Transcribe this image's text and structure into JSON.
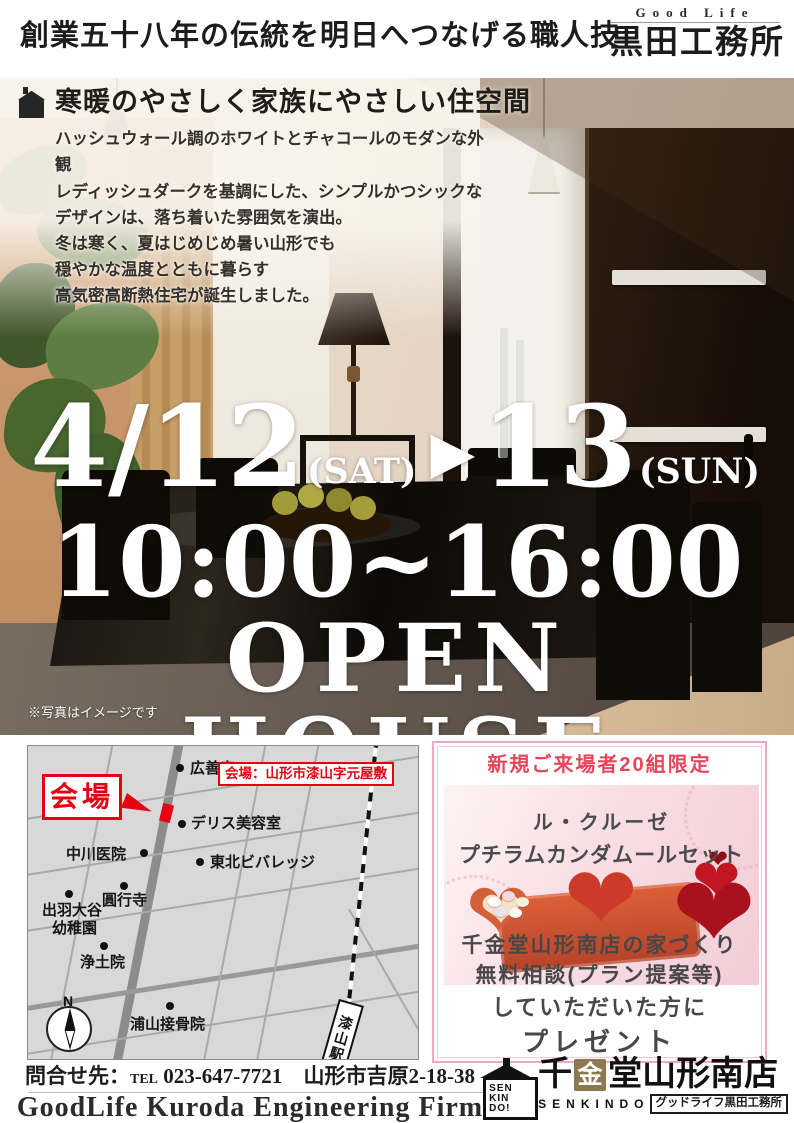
{
  "header": {
    "tagline": "創業五十八年の伝統を明日へつなげる職人技",
    "brand_en": "Good Life",
    "brand_ja": "黒田工務所"
  },
  "hero": {
    "headline": "寒暖のやさしく家族にやさしい住空間",
    "description_lines": [
      "ハッシュウォール調のホワイトとチャコールのモダンな外観",
      "レディッシュダークを基調にした、シンプルかつシックな",
      "デザインは、落ち着いた雰囲気を演出。",
      "冬は寒く、夏はじめじめ暑い山形でも",
      "穏やかな温度とともに暮らす",
      "高気密高断熱住宅が誕生しました。"
    ],
    "date_start": "4/12",
    "date_start_day": "(SAT)",
    "arrow": "▶",
    "date_end": "13",
    "date_end_day": "(SUN)",
    "time": "10:00~16:00",
    "event_title": "OPEN HOUSE",
    "photo_note": "※写真はイメージです"
  },
  "map": {
    "venue_label": "会場",
    "venue_address": "会場：山形市漆山字元屋敷",
    "compass": "N",
    "station": "漆山駅",
    "landmarks": {
      "kozenji": "広善寺",
      "delis": "デリス美容室",
      "nakagawa": "中川医院",
      "tohoku": "東北ビバレッジ",
      "enkoji": "圓行寺",
      "dewa1": "出羽大谷",
      "dewa2": "幼稚園",
      "jodoin": "浄土院",
      "urayama": "浦山接骨院"
    }
  },
  "prize": {
    "limit": "新規ご来場者20組限定",
    "product_line1": "ル・クルーゼ",
    "product_line2": "プチラムカンダムールセット",
    "condition_line1": "千金堂山形南店の家づくり",
    "condition_line2": "無料相談(プラン提案等)",
    "condition_line3": "していただいた方に",
    "condition_line4": "プレゼント",
    "heart_glyph": "❤"
  },
  "footer": {
    "contact_prefix": "問合せ先：",
    "tel_label": "TEL",
    "tel_number": "023-647-7721",
    "address": "山形市吉原2-18-38",
    "company_en": "GoodLife Kuroda Engineering Firm",
    "logo": {
      "badge_line1": "SEN",
      "badge_line2": "KIN",
      "badge_line3": "DO!",
      "name_pre": "千",
      "name_gold": "金",
      "name_post": "堂",
      "branch": "山形南店",
      "romaji": "SENKINDO",
      "subtitle": "グッドライフ黒田工務所"
    }
  },
  "colors": {
    "accent_red": "#e60012",
    "prize_pink": "#f0a9be",
    "prize_red": "#e8465a",
    "gold": "#8c7950"
  }
}
